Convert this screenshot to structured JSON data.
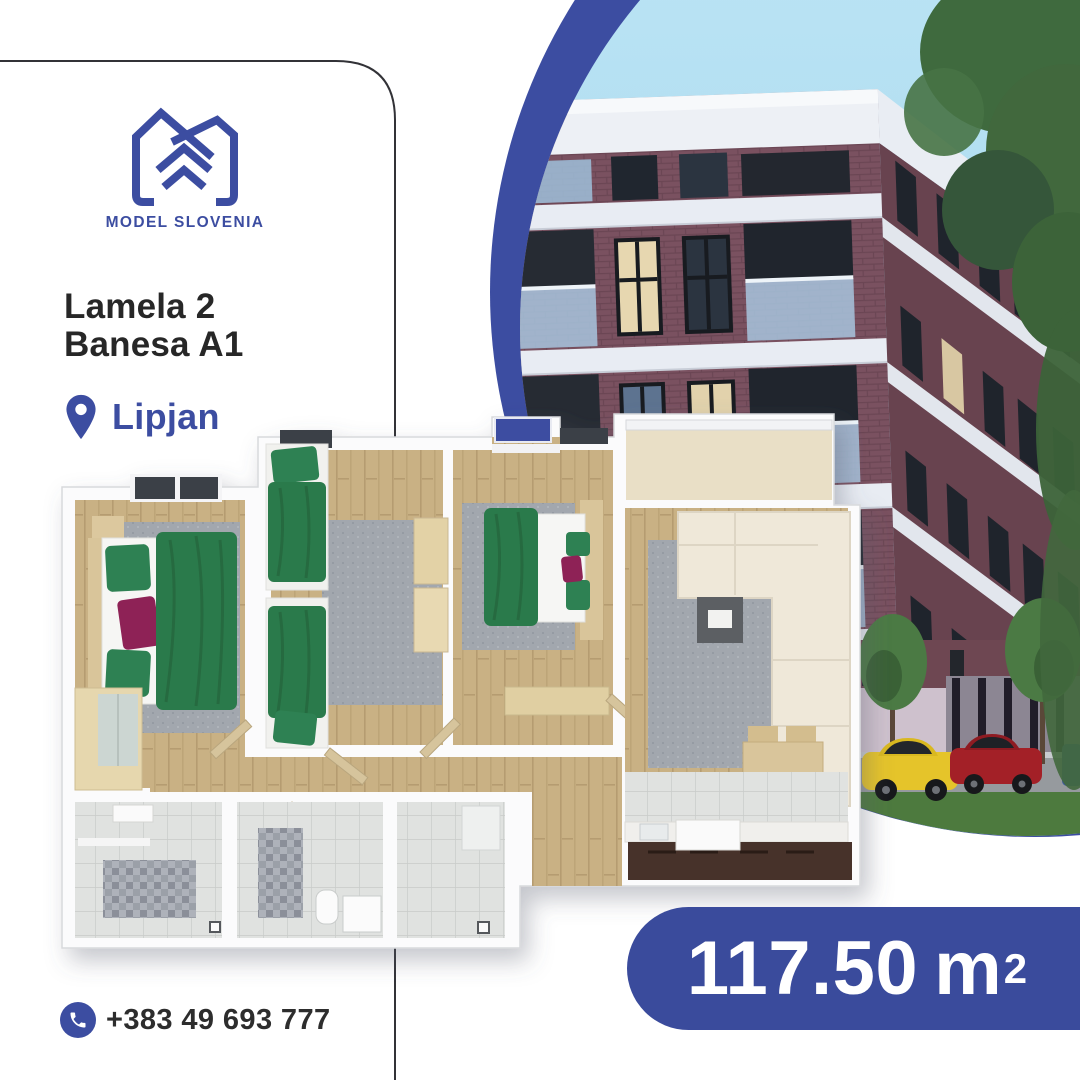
{
  "brand": {
    "name": "MODEL SLOVENIA"
  },
  "listing": {
    "block": "Lamela 2",
    "unit": "Banesa A1",
    "location": "Lipjan"
  },
  "area": {
    "value": "117.50",
    "unit": "m",
    "exponent": "2"
  },
  "contact": {
    "phone": "+383 49 693 777"
  },
  "icons": {
    "logo": "house-logo-icon",
    "location": "location-pin-icon",
    "phone": "phone-icon"
  },
  "colors": {
    "brand_blue": "#3c4da1",
    "pill_blue": "#3a4b9c",
    "text_dark": "#272727",
    "sky": "#a7daf0",
    "brick": "#7a5160",
    "grass": "#4d7a3e",
    "wood_floor": "#c9b184",
    "duvet_green": "#2c7a4b",
    "pillow_magenta": "#8e2357"
  }
}
